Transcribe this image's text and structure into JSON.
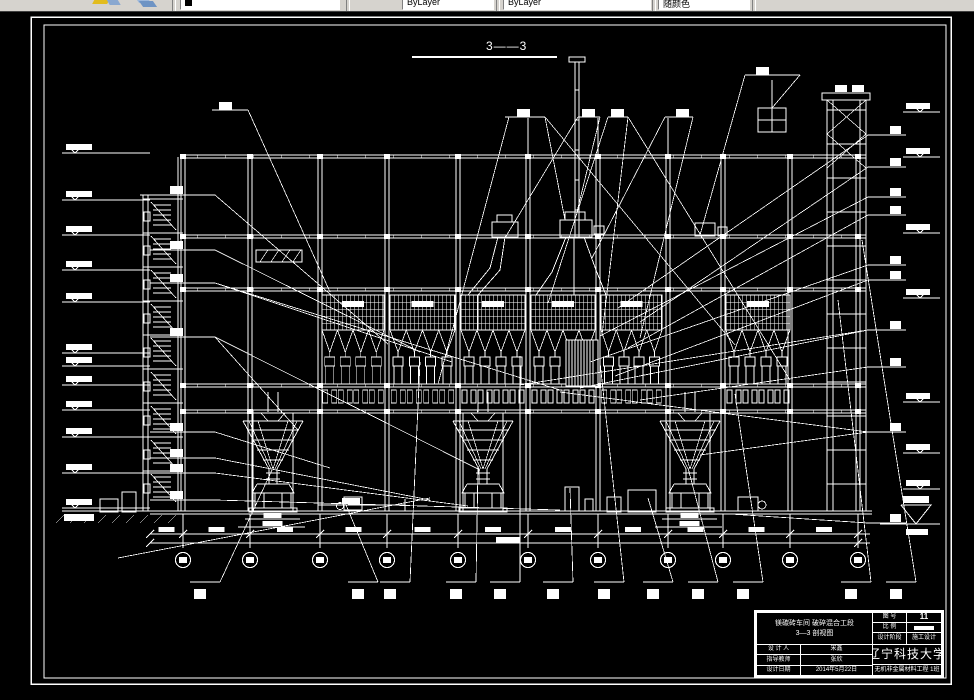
{
  "toolbar": {
    "icons": [
      {
        "name": "match-properties-icon"
      },
      {
        "name": "layers-icon"
      }
    ],
    "combos": [
      {
        "name": "layer-combo",
        "value": ""
      },
      {
        "name": "color-combo",
        "value": "ByLayer"
      },
      {
        "name": "linetype-combo",
        "value": "ByLayer"
      },
      {
        "name": "plotstyle-combo",
        "value": "随颜色"
      }
    ]
  },
  "drawing": {
    "section_title": "3——3"
  },
  "title_block": {
    "project_line1": "镁碳砖车间  破碎混合工段",
    "project_line2": "3—3 剖视图",
    "drawing_no_label": "图  号",
    "drawing_no": "11",
    "scale_label": "比  例",
    "stage_label": "设计阶段",
    "stage": "施工设计",
    "designer_label": "设 计 人",
    "designer": "宋鑫",
    "advisor_label": "指导教师",
    "advisor": "张欣",
    "date_label": "设计日期",
    "date": "2014年5月22日",
    "university": "辽宁科技大学",
    "class": "无机非金属材料工程 1班"
  },
  "colors": {
    "background": "#000000",
    "line": "#ffffff",
    "toolbar_bg": "#d6d3ce"
  }
}
